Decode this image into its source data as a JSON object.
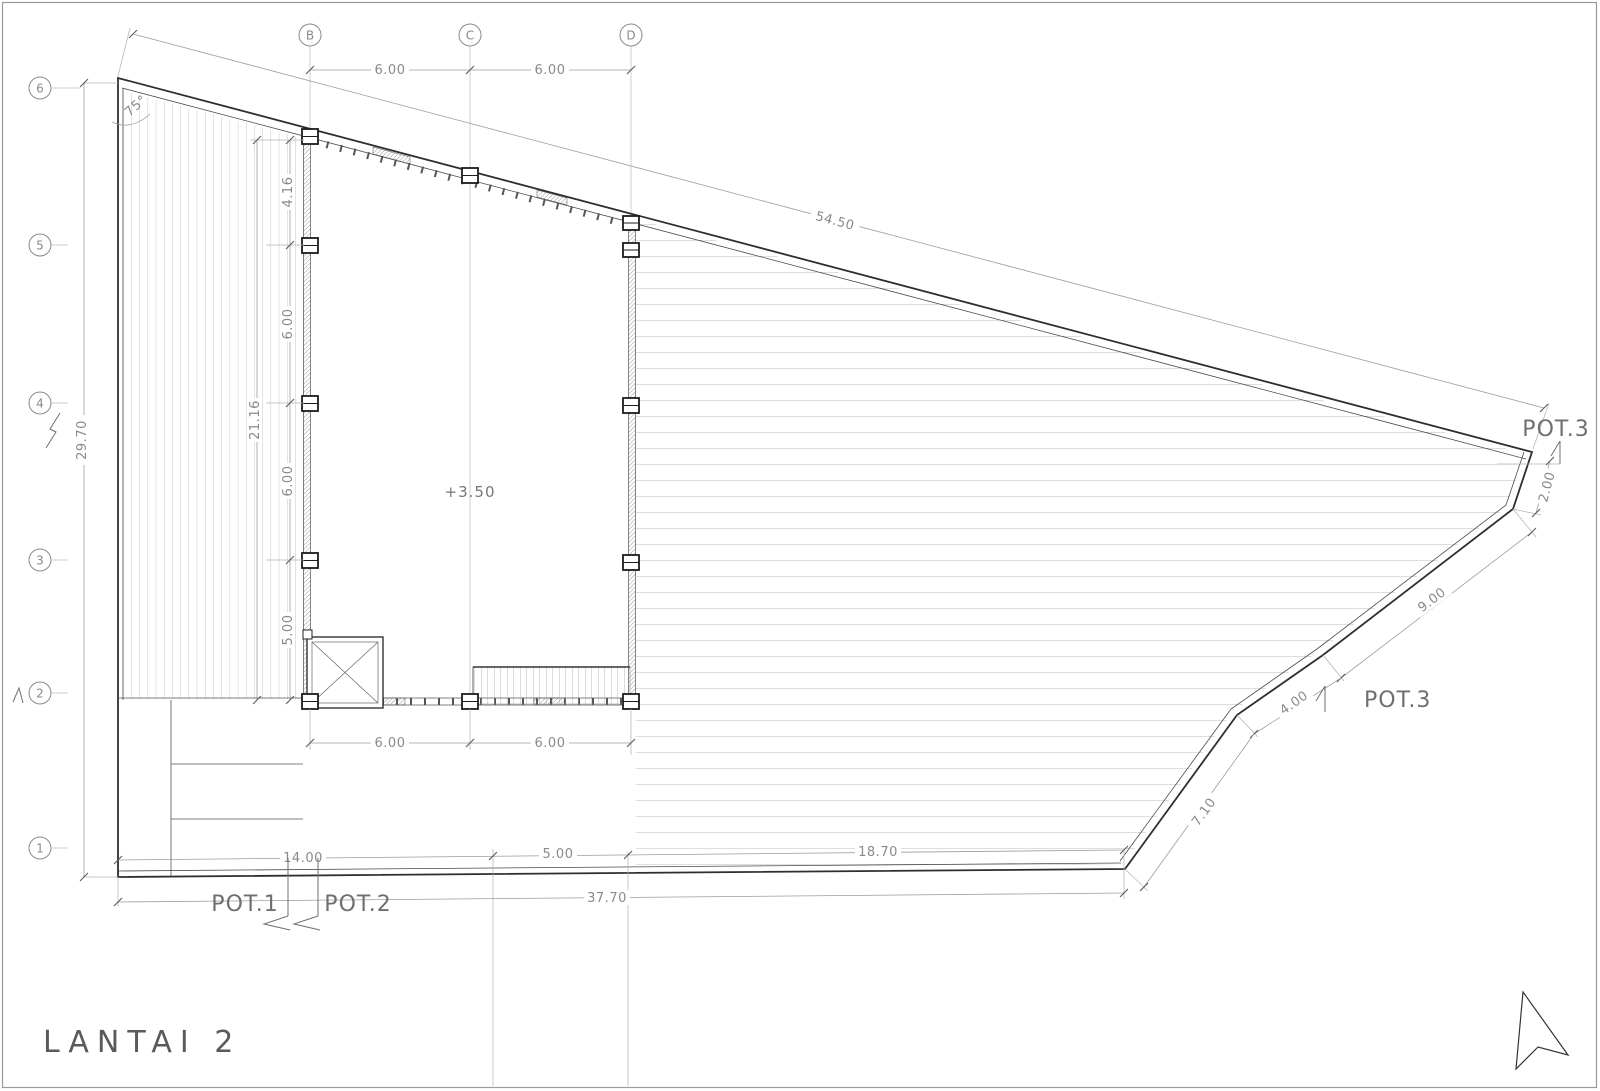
{
  "sheet": {
    "title": "LANTAI 2"
  },
  "plan": {
    "level_label": "+3.50",
    "angle_label": "75°"
  },
  "grid": {
    "top_columns": [
      "B",
      "C",
      "D"
    ],
    "left_rows": [
      "6",
      "5",
      "4",
      "3",
      "2",
      "1"
    ]
  },
  "dims": {
    "top_bay_1": "6.00",
    "top_bay_2": "6.00",
    "roof_edge_total": "54.50",
    "left_total": "29.70",
    "inner_total": "21.16",
    "inner_1": "4.16",
    "inner_2": "6.00",
    "inner_3": "6.00",
    "inner_4": "5.00",
    "bottom_bay_1": "6.00",
    "bottom_bay_2": "6.00",
    "bottom_1": "14.00",
    "bottom_2": "5.00",
    "bottom_3": "18.70",
    "bottom_total": "37.70",
    "right_1": "2.00",
    "right_2": "9.00",
    "right_3": "4.00",
    "right_4": "7.10"
  },
  "sections": {
    "pot1": "POT.1",
    "pot2": "POT.2",
    "pot3_top": "POT.3",
    "pot3_side": "POT.3"
  },
  "colors": {
    "outline": "#2e2e2e",
    "dimension": "#9d9d9d",
    "hatch": "#b8b8b8",
    "text": "#8a8a8a"
  }
}
